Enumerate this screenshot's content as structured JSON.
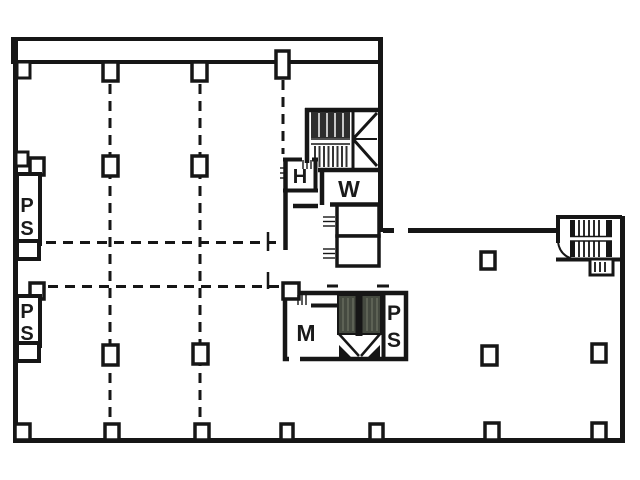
{
  "colors": {
    "wall": "#161616",
    "background": "#ffffff",
    "stair_fill": "#454a40"
  },
  "rooms": {
    "pipe_shaft_upper_left": {
      "letters": [
        "P",
        "S"
      ]
    },
    "pipe_shaft_lower_left": {
      "letters": [
        "P",
        "S"
      ]
    },
    "h_room": {
      "label": "H"
    },
    "w_room": {
      "label": "W"
    },
    "m_room": {
      "label": "M"
    },
    "pipe_shaft_core": {
      "letters": [
        "P",
        "S"
      ]
    }
  }
}
